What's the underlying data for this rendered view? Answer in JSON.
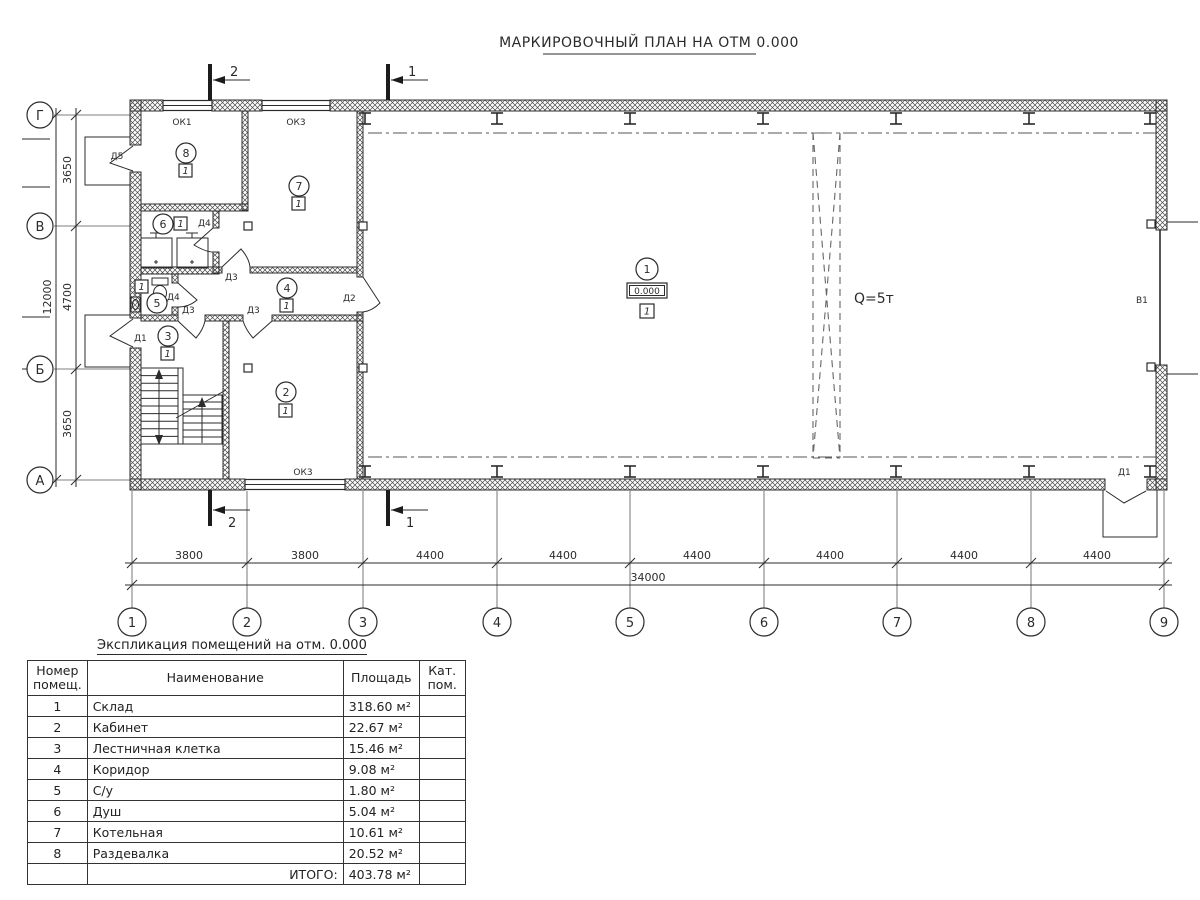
{
  "title": "МАРКИРОВОЧНЫЙ ПЛАН НА ОТМ 0.000",
  "plan": {
    "axes_h": [
      "1",
      "2",
      "3",
      "4",
      "5",
      "6",
      "7",
      "8",
      "9"
    ],
    "axes_v": [
      "Г",
      "В",
      "Б",
      "А"
    ],
    "dims_bottom": [
      "3800",
      "3800",
      "4400",
      "4400",
      "4400",
      "4400",
      "4400",
      "4400"
    ],
    "dim_bottom_total": "34000",
    "dims_left": [
      "3650",
      "4700",
      "3650"
    ],
    "dim_left_total": "12000",
    "section_mark_1": "1",
    "section_mark_2": "2",
    "elevation": "0.000",
    "crane_capacity": "Q=5т",
    "gate_label": "В1",
    "room_numbers": [
      "1",
      "2",
      "3",
      "4",
      "5",
      "6",
      "7",
      "8"
    ],
    "type_marker": "1",
    "door_labels": {
      "d5": "Д5",
      "d4_shower": "Д4",
      "d4_wc": "Д4",
      "d3_boiler": "Д3",
      "d3_stairs": "Д3",
      "d3_office": "Д3",
      "d2": "Д2",
      "d1_left": "Д1",
      "d1_right": "Д1"
    },
    "window_labels": {
      "ok1": "ОК1",
      "ok3_top": "ОК3",
      "ok3_bottom": "ОК3"
    }
  },
  "table": {
    "title": "Экспликация помещений на отм. 0.000",
    "col_num_line1": "Номер",
    "col_num_line2": "помещ.",
    "col_name": "Наименование",
    "col_area": "Площадь",
    "col_cat_line1": "Кат.",
    "col_cat_line2": "пом.",
    "rows": [
      {
        "num": "1",
        "name": "Склад",
        "area": "318.60 м²"
      },
      {
        "num": "2",
        "name": "Кабинет",
        "area": "22.67 м²"
      },
      {
        "num": "3",
        "name": "Лестничная клетка",
        "area": "15.46 м²"
      },
      {
        "num": "4",
        "name": "Коридор",
        "area": "9.08 м²"
      },
      {
        "num": "5",
        "name": "С/у",
        "area": "1.80 м²"
      },
      {
        "num": "6",
        "name": "Душ",
        "area": "5.04 м²"
      },
      {
        "num": "7",
        "name": "Котельная",
        "area": "10.61 м²"
      },
      {
        "num": "8",
        "name": "Раздевалка",
        "area": "20.52 м²"
      }
    ],
    "total_label": "ИТОГО:",
    "total_area": "403.78 м²"
  }
}
